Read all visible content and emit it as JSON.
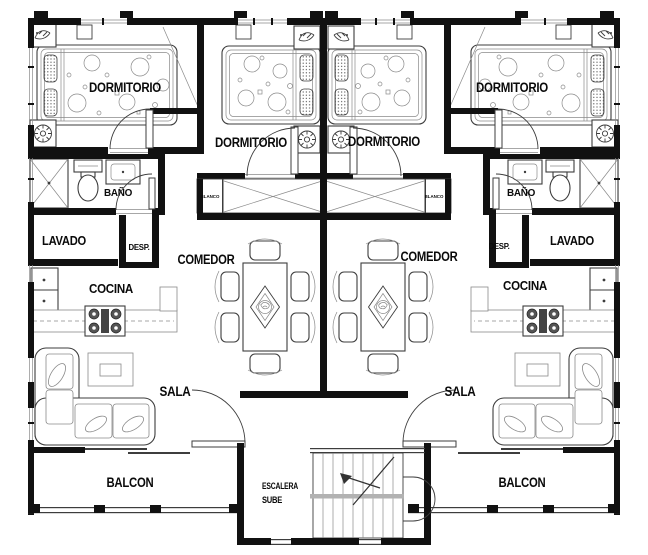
{
  "plan": {
    "title": "apartment-floor-plan",
    "labels": {
      "dormitorio": "DORMITORIO",
      "bano": "BAÑO",
      "lavado": "LAVADO",
      "desp": "DESP.",
      "comedor": "COMEDOR",
      "cocina": "COCINA",
      "sala": "SALA",
      "balcon": "BALCON",
      "blanco": "BLANCO",
      "escalera": "ESCALERA",
      "sube": "SUBE"
    },
    "colors": {
      "wall": "#111111",
      "line": "#3d3d3d",
      "light": "#8a8a8a",
      "landing": "#b2b2b2",
      "bg": "#ffffff"
    }
  }
}
